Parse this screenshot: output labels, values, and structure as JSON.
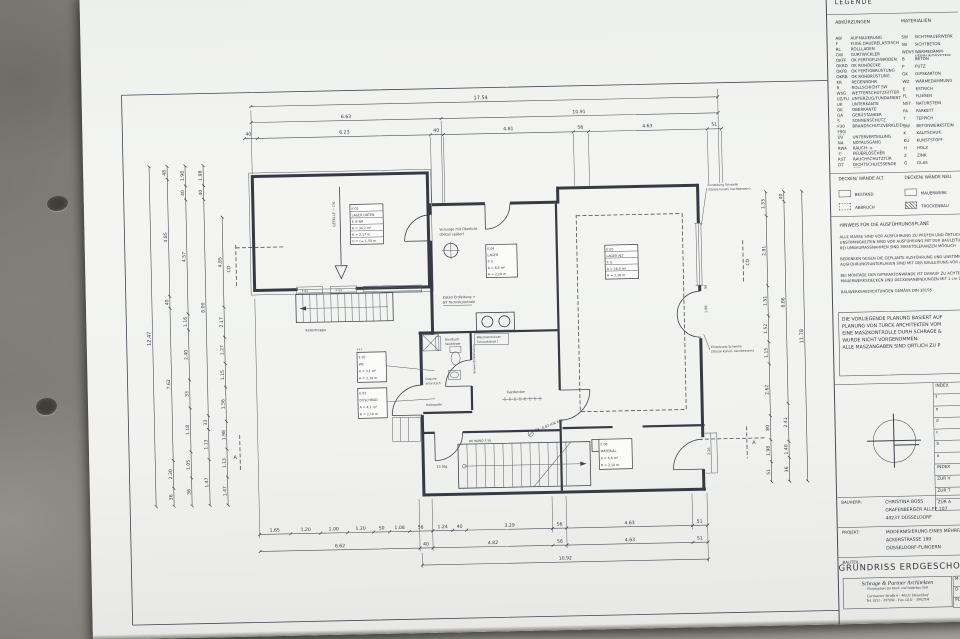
{
  "legend": {
    "title": "LEGENDE",
    "col1_header": "ABKÜRZUNGEN",
    "col2_header": "MATERIALIEN",
    "abbreviations": [
      {
        "k": "AW",
        "v": "AUFMAUERUNG"
      },
      {
        "k": "F",
        "v": "FUGE DAUERELASTISCH"
      },
      {
        "k": "RL",
        "v": "ROLLLADEN"
      },
      {
        "k": "GW",
        "v": "GURTWICKLER"
      },
      {
        "k": "OKFF",
        "v": "OK FERTIGFUSSBODEN"
      },
      {
        "k": "OKRD",
        "v": "OK ROHDECKE"
      },
      {
        "k": "OKFB",
        "v": "OK FERTIGBRÜSTUNG"
      },
      {
        "k": "OKRB",
        "v": "OK ROHBRÜSTUNG"
      },
      {
        "k": "KR",
        "v": "REGENROHR"
      },
      {
        "k": "R",
        "v": "ROLLSCHICHT SW"
      },
      {
        "k": "WSG",
        "v": "WETTERSCHUTZGITTER"
      },
      {
        "k": "UZ/FU",
        "v": "UNTERZUG/FUNDAMENT"
      },
      {
        "k": "UK",
        "v": "UNTERKANTE"
      },
      {
        "k": "OK",
        "v": "OBERKANTE"
      },
      {
        "k": "GA",
        "v": "GERÜSTANKER"
      },
      {
        "k": "S",
        "v": "SONNENSCHUTZ"
      },
      {
        "k": "F30",
        "v": "BRANDSCHUTZVERKLEIDUNG"
      },
      {
        "k": "F90/ F30",
        "v": ""
      },
      {
        "k": "UV",
        "v": "UNTERVERTEILUNG"
      },
      {
        "k": "NA",
        "v": "NOTAUSGANG"
      },
      {
        "k": "RWA",
        "v": "RAUCH- u. WÄRMEABZUG"
      },
      {
        "k": "Ⓕ",
        "v": "FEUERLÖSCHER"
      },
      {
        "k": "RST",
        "v": "RAUCHSCHUTZTÜR"
      },
      {
        "k": "DT",
        "v": "DICHTSCHLIESSENDE TÜR"
      }
    ],
    "materials": [
      {
        "k": "SW",
        "v": "SICHTMAUERWERK"
      },
      {
        "k": "SB",
        "v": "SICHTBETON"
      },
      {
        "k": "WDVS",
        "v": "WÄRMEDÄMM- VERBUNDSYSTEM"
      },
      {
        "k": "B",
        "v": "BETON"
      },
      {
        "k": "P",
        "v": "PUTZ"
      },
      {
        "k": "GK",
        "v": "GIPSKARTON"
      },
      {
        "k": "WD",
        "v": "WÄRMEDÄMMUNG"
      },
      {
        "k": "E",
        "v": "ESTRICH"
      },
      {
        "k": "FL",
        "v": "FLIESEN"
      },
      {
        "k": "NST",
        "v": "NATURSTEIN"
      },
      {
        "k": "PA",
        "v": "PARKETT"
      },
      {
        "k": "T",
        "v": "TEPPICH"
      },
      {
        "k": "BW",
        "v": "BETONWERKSTEIN"
      },
      {
        "k": "K",
        "v": "KAUTSCHUK"
      },
      {
        "k": "KU",
        "v": "KUNSTSTOFF"
      },
      {
        "k": "H",
        "v": "HOLZ"
      },
      {
        "k": "Z",
        "v": "ZINK"
      },
      {
        "k": "G",
        "v": "GLAS"
      }
    ],
    "old_header": "DECKEN/ WÄNDE ALT.",
    "new_header": "DECKEN/ WÄNDE NEU.",
    "swatches": {
      "bestand": "BESTAND",
      "abbruch": "ABBRUCH",
      "mauerwerk": "MAUERWERK",
      "trockenbau": "TROCKENBAU"
    }
  },
  "hinweis": {
    "title": "HINWEIS FÜR DIE AUSFÜHRUNGSPLÄNE",
    "lines": [
      "ALLE MASSE SIND VOR AUSFÜHRUNG ZU PRÜFEN UND ÖRTLICH ZU MES",
      "UNSTIMMIGKEITEN SIND VOR AUSFÜHRUNG MIT DER BAULEITUNG ZU KLÄR",
      "BEI UMBAUMASSNAHMEN SIND MASSTOLERANZEN MÖGLICH",
      "",
      "BEDENKEN GEGEN DIE GEPLANTE AUSFÜHRUNG UND UNSTIMMIGKEITEN IN",
      "AUSFÜHRUNGSUNTERLAGEN SIND MIT DER BAULEITUNG VOR AUSFÜHRUNG",
      "",
      "BEI MONTAGE DER GIPSKARTONWÄNDE IST DARAUF ZU ACHTEN, DASS A",
      "MAUERWERKSDECKEN UND DECKENANBINDUNGEN MIT 1 cm ÜBERSTAND HERGES",
      "",
      "BAUWERKSABDICHTUNGEN GEMÄSS DIN 18195"
    ]
  },
  "notebox": {
    "lines": [
      "DIE VORLIEGENDE PLANUNG BASIERT AUF",
      "PLANUNG VON TURCK ARCHITEKTEN VOM",
      "EINE MASZKONTROLLE DURH SCHRAGE &",
      "WURDE NICHT VORGENOMMEN.",
      "ALLE MASZANGABEN SIND ORTLICH ZU P"
    ]
  },
  "index_table": {
    "rows": [
      "INDEX",
      "f",
      "e",
      "d",
      "c",
      "b",
      "a",
      "INDEX",
      "ZUR V",
      "ZUR T",
      "ZUR A"
    ]
  },
  "titleblock": {
    "bauherr_label": "BAUHERR:",
    "bauherr": [
      "CHRISTINA BOSS",
      "GRAFENBERGER ALLEE 107",
      "40237 DÜSSELDORF"
    ],
    "projekt_label": "PROJEKT:",
    "projekt": [
      "MODERNISIERUNG EINES MEHRFAMILIENHAUSES",
      "ACKERSTRASSE 199",
      "DÜSSELDORF-FLINGERN"
    ],
    "bauteil_label": "BAUTEIL:",
    "sheet_title": "GRUNDRISS ERDGESCHOSS",
    "architect": [
      "Schrage & Partner Architekten",
      "Planungsbüro für Hoch- und Städtebau GbR",
      "Curtiuserer Straße 6 - 40221 Düsseldorf",
      "Tel. 0211 - 397004 - Fax. 0211 - 3982704"
    ],
    "mini": {
      "m": "M",
      "d": "D",
      "plan": "PLAN"
    }
  },
  "plan": {
    "dims_top": {
      "total": "17.54",
      "row2": [
        "6.63",
        "10.91"
      ],
      "row3": [
        "40",
        "6.23",
        "40",
        "4.81",
        "56",
        "4.63",
        "51"
      ]
    },
    "dims_bottom": {
      "row1": [
        "1.65",
        "1.20",
        "1.00",
        "1.20",
        "50",
        "1.08",
        "56",
        "1.24",
        "40",
        "3.29",
        "56",
        "4.63",
        "51"
      ],
      "row2": [
        "6.62",
        "40",
        "4.82",
        "56",
        "4.63",
        "51"
      ],
      "total": "10.92"
    },
    "dims_left": {
      "total": "12.47",
      "c2": [
        "48",
        "4.85",
        "40",
        "7.62",
        "2.30",
        "36"
      ],
      "c3": [
        "1.98",
        "40",
        "4.57",
        "1.16",
        "2.40",
        "33",
        "1.18",
        "1.05",
        "36"
      ],
      "c4": [
        "1.98",
        "40",
        "8.00",
        "33",
        "1.13",
        "1.47"
      ],
      "c5": [
        "4.85",
        "2.17",
        "1.27",
        "1.15",
        "1.56",
        "1.98",
        "1.13",
        "1.47"
      ]
    },
    "dims_right": {
      "total": "11.78",
      "c1": [
        "1.55",
        "2.81",
        "1.51",
        "1.52",
        "1.15",
        "2.62",
        "80",
        "1.98",
        "51"
      ],
      "c2": [
        "40",
        "8.86",
        "2.41",
        "1.40",
        "36"
      ]
    },
    "wall_dims": [
      "56",
      "1.88",
      "2.26"
    ],
    "stamps": {
      "r1": [
        "E 01",
        "LAGER UNTEN",
        "F: B   NR",
        "A = 34,2 m²",
        "H = 2,17 m",
        "U = ca. 1,50 m"
      ],
      "r2": [
        "E 04",
        "LAGER",
        "F: E",
        "A = 8,6 m²",
        "H = 2,10 m"
      ],
      "r3": [
        "E 05",
        "LAGER ALT",
        "F: E",
        "A = 26,4 m²",
        "H = 2,10 m"
      ],
      "r4": [
        "E 02",
        "WC",
        "A = 3,1 m²",
        "H = 2,10 m"
      ],
      "r5": [
        "E 03",
        "DUSCHBAD",
        "A = 4,2 m²",
        "H = 2,10 m"
      ],
      "r6": [
        "E 06",
        "MATERIAL",
        "A = 6,8 m²",
        "H = 2,10 m"
      ]
    },
    "labels": {
      "kellertreppe": "Kellertreppe",
      "gefaelle": "GEFÄLLE ~ 1%",
      "f1": "F 01",
      "f2": "F 02",
      "oberlicht1": "Vorsorge mit Oberlicht",
      "oberlicht2": "(Detail später)",
      "daten1": "Daten Erdleitung +",
      "daten2": "NT Technikzentrale",
      "waesche1": "Wäschetrockner",
      "waesche2": "Schutzklasse I",
      "handtuch1": "Handtuch-",
      "handtuch2": "heizkörper",
      "dusche1": "Dusche",
      "dusche2": "antirutsch",
      "haltegriffe": "Haltegriffe",
      "vorwand": "Vorwandinstallation",
      "garderobe": "Garderobe",
      "level": "OK -0,02 (OK EG)",
      "okwand": "OK WAND 7,50",
      "stg": "13 Stg",
      "fenster1a": "Einsetzung Schwelle",
      "fenster1b": "(Stürze künstl. nachbessern)",
      "sectionCD": "CD",
      "sectionA": "A"
    }
  }
}
